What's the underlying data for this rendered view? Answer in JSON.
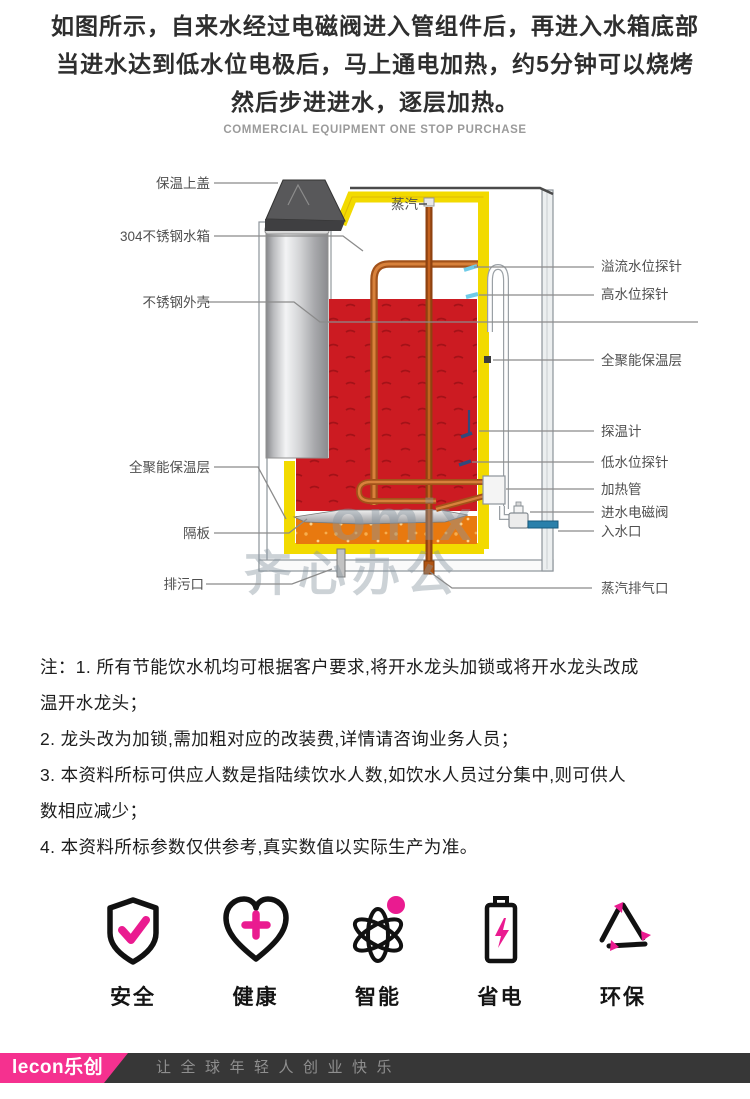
{
  "header": {
    "line1": "如图所示，自来水经过电磁阀进入管组件后，再进入水箱底部",
    "line2": "当进水达到低水位电极后，马上通电加热，约5分钟可以烧烤",
    "line3": "然后步进进水，逐层加热。",
    "subtitle": "COMMERCIAL EQUIPMENT ONE STOP PURCHASE"
  },
  "diagram": {
    "steam_label": "蒸汽",
    "labels_left": [
      "保温上盖",
      "304不锈钢水箱",
      "不锈钢外壳",
      "全聚能保温层",
      "隔板",
      "排污口"
    ],
    "labels_right": [
      "溢流水位探针",
      "高水位探针",
      "全聚能保温层",
      "探温计",
      "低水位探针",
      "加热管",
      "进水电磁阀",
      "入水口",
      "蒸汽排气口"
    ],
    "watermark_line1": "omix",
    "watermark_line2": "齐心办公"
  },
  "notes": {
    "lines": [
      "注：1. 所有节能饮水机均可根据客户要求,将开水龙头加锁或将开水龙头改成",
      "温开水龙头；",
      "2. 龙头改为加锁,需加粗对应的改装费,详情请咨询业务人员；",
      "3. 本资料所标可供应人数是指陆续饮水人数,如饮水人员过分集中,则可供人",
      "数相应减少；",
      "4. 本资料所标参数仅供参考,真实数值以实际生产为准。"
    ]
  },
  "features": [
    {
      "label": "安全"
    },
    {
      "label": "健康"
    },
    {
      "label": "智能"
    },
    {
      "label": "省电"
    },
    {
      "label": "环保"
    }
  ],
  "footer": {
    "logo": "lecon乐创",
    "slogan": "让全球年轻人创业快乐"
  },
  "colors": {
    "accent_pink": "#ea1b90",
    "hot_water_red": "#cc1b22",
    "warm_water_orange": "#e8790f",
    "insulation_yellow": "#f2da00",
    "copper_pipe": "#a2521a",
    "inlet_blue": "#2a80ab",
    "footer_bg": "#373737",
    "logo_pink": "#f5318f"
  }
}
